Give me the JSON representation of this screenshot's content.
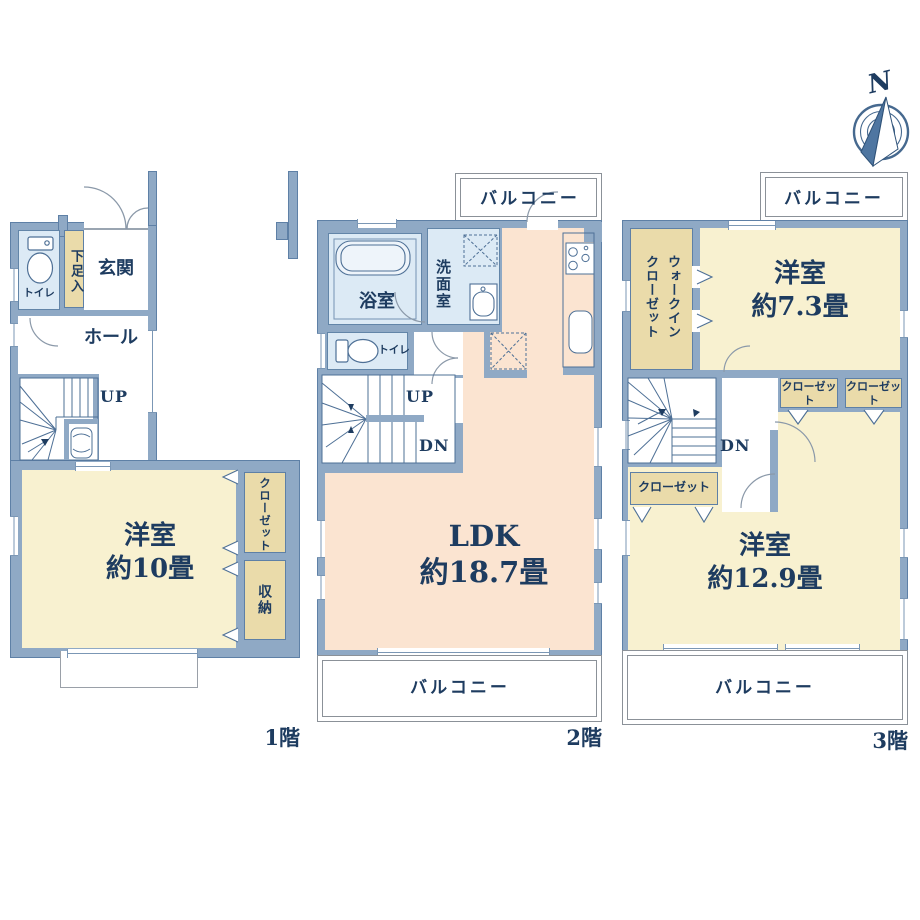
{
  "compass": {
    "north_label": "N"
  },
  "floor1": {
    "floor_label": "1階",
    "toilet": "トイレ",
    "shoe_storage": "下足入",
    "entrance": "玄関",
    "hall": "ホール",
    "stairs_up": "UP",
    "bedroom": {
      "name": "洋室",
      "size": "約10畳"
    },
    "closet": "クローゼット",
    "storage": "収納"
  },
  "floor2": {
    "floor_label": "2階",
    "balcony_top": "バルコニー",
    "bathroom": "浴室",
    "washroom": "洗面室",
    "toilet": "トイレ",
    "stairs_up": "UP",
    "stairs_down": "DN",
    "ldk": {
      "name": "LDK",
      "size": "約18.7畳"
    },
    "balcony_bottom": "バルコニー"
  },
  "floor3": {
    "floor_label": "3階",
    "balcony_top": "バルコニー",
    "walk_in_closet": "ウォークインクローゼット",
    "bedroom_a": {
      "name": "洋室",
      "size": "約7.3畳"
    },
    "closet_a": "クローゼット",
    "closet_b": "クローゼット",
    "stairs_down": "DN",
    "closet_c": "クローゼット",
    "bedroom_b": {
      "name": "洋室",
      "size": "約12.9畳"
    },
    "balcony_bottom": "バルコニー"
  },
  "colors": {
    "wall": "#8fa9c5",
    "room_cream": "#f8f1d0",
    "closet_tan": "#eadbaa",
    "ldk_peach": "#fbe4d1",
    "wet_blue": "#dceaf5",
    "text_navy": "#1e3c60"
  }
}
